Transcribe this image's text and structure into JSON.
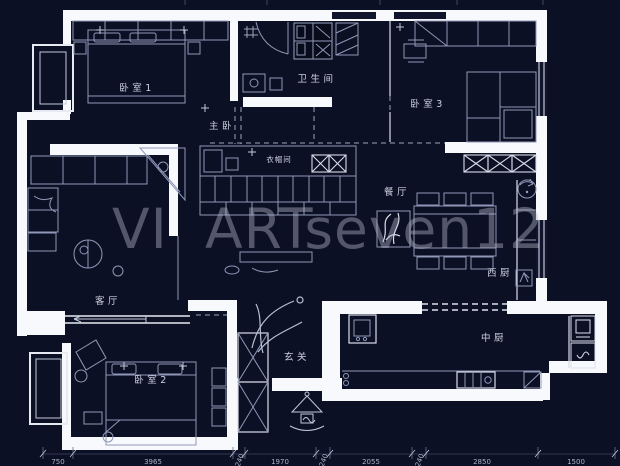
{
  "canvas": {
    "width": 620,
    "height": 466,
    "background": "#0c1024"
  },
  "colors": {
    "wall": "#f8f9fc",
    "furniture_line": "#8f98b8",
    "bright_line": "#d9dde9",
    "label_text": "#ccd1df",
    "dimension_text": "#a9b1c7",
    "watermark_text": "#b6bac8"
  },
  "watermark": {
    "part1": "VI",
    "part2": "ARTseven12"
  },
  "rooms": [
    {
      "id": "bedroom-1",
      "label": "卧室1"
    },
    {
      "id": "master-bedroom",
      "label": "主卧"
    },
    {
      "id": "bathroom",
      "label": "卫生间"
    },
    {
      "id": "bedroom-3",
      "label": "卧室3"
    },
    {
      "id": "cloakroom",
      "label": "衣帽间"
    },
    {
      "id": "dining-room",
      "label": "餐厅"
    },
    {
      "id": "west-kitchen",
      "label": "西厨"
    },
    {
      "id": "living-room",
      "label": "客厅"
    },
    {
      "id": "foyer",
      "label": "玄关"
    },
    {
      "id": "chinese-kitchen",
      "label": "中厨"
    },
    {
      "id": "bedroom-2",
      "label": "卧室2"
    }
  ],
  "dimensions_bottom": [
    "750",
    "3965",
    "240",
    "1970",
    "240",
    "2055",
    "240",
    "2850",
    "1500"
  ]
}
